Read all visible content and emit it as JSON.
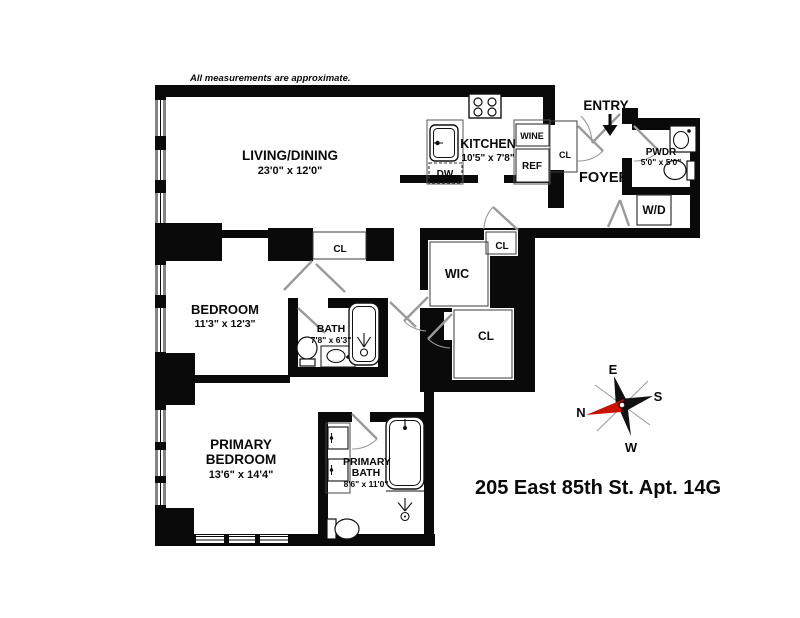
{
  "disclaimer": "All measurements are approximate.",
  "address": "205 East 85th St. Apt. 14G",
  "colors": {
    "wall": "#000000",
    "door": "#9a9a9a",
    "compass_north": "#cc1100"
  },
  "rooms": {
    "living_dining": {
      "name": "LIVING/DINING",
      "dims": "23'0\" x 12'0\""
    },
    "kitchen": {
      "name": "KITCHEN",
      "dims": "10'5\" x 7'8\""
    },
    "bedroom": {
      "name": "BEDROOM",
      "dims": "11'3\" x 12'3\""
    },
    "bath": {
      "name": "BATH",
      "dims": "7'8\" x 6'3\""
    },
    "primary_bedroom": {
      "name_line1": "PRIMARY",
      "name_line2": "BEDROOM",
      "dims": "13'6\" x 14'4\""
    },
    "primary_bath": {
      "name_line1": "PRIMARY",
      "name_line2": "BATH",
      "dims": "8'6\" x 11'0\""
    },
    "powder_room": {
      "name": "PWDR",
      "dims": "5'0\" x 5'0\""
    },
    "foyer": {
      "name": "FOYER"
    },
    "entry": {
      "name": "ENTRY"
    },
    "walk_in_closet": {
      "name": "WIC"
    },
    "laundry": {
      "name": "W/D"
    },
    "closets": {
      "foyer_cl": "CL",
      "hall_cl_top": "CL",
      "hall_cl_right": "CL",
      "hall_cl_lower": "CL"
    }
  },
  "appliances": {
    "dishwasher": "DW",
    "refrigerator": "REF",
    "wine_cooler": "WINE"
  },
  "compass": {
    "north": "N",
    "east": "E",
    "south": "S",
    "west": "W"
  }
}
